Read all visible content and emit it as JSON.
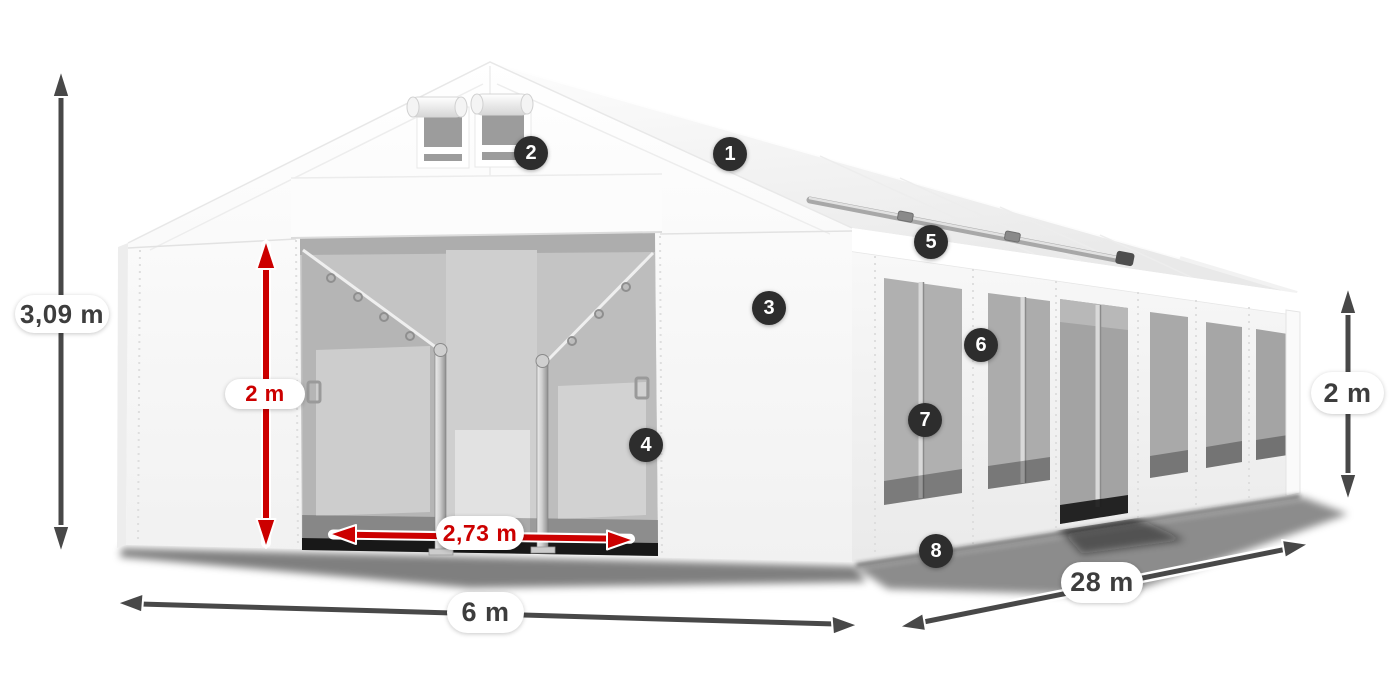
{
  "dimensions": {
    "total_height": {
      "label": "3,09 m"
    },
    "door_height": {
      "label": "2 m"
    },
    "door_width": {
      "label": "2,73 m"
    },
    "front_width": {
      "label": "6 m"
    },
    "side_length": {
      "label": "28 m"
    },
    "side_height": {
      "label": "2 m"
    }
  },
  "callouts": [
    {
      "number": "1"
    },
    {
      "number": "2"
    },
    {
      "number": "3"
    },
    {
      "number": "4"
    },
    {
      "number": "5"
    },
    {
      "number": "6"
    },
    {
      "number": "7"
    },
    {
      "number": "8"
    }
  ],
  "colors": {
    "dimension_red": "#cc0000",
    "dimension_gray": "#484848",
    "callout_background": "#2d2d2d",
    "label_text": "#3d3d3d"
  }
}
